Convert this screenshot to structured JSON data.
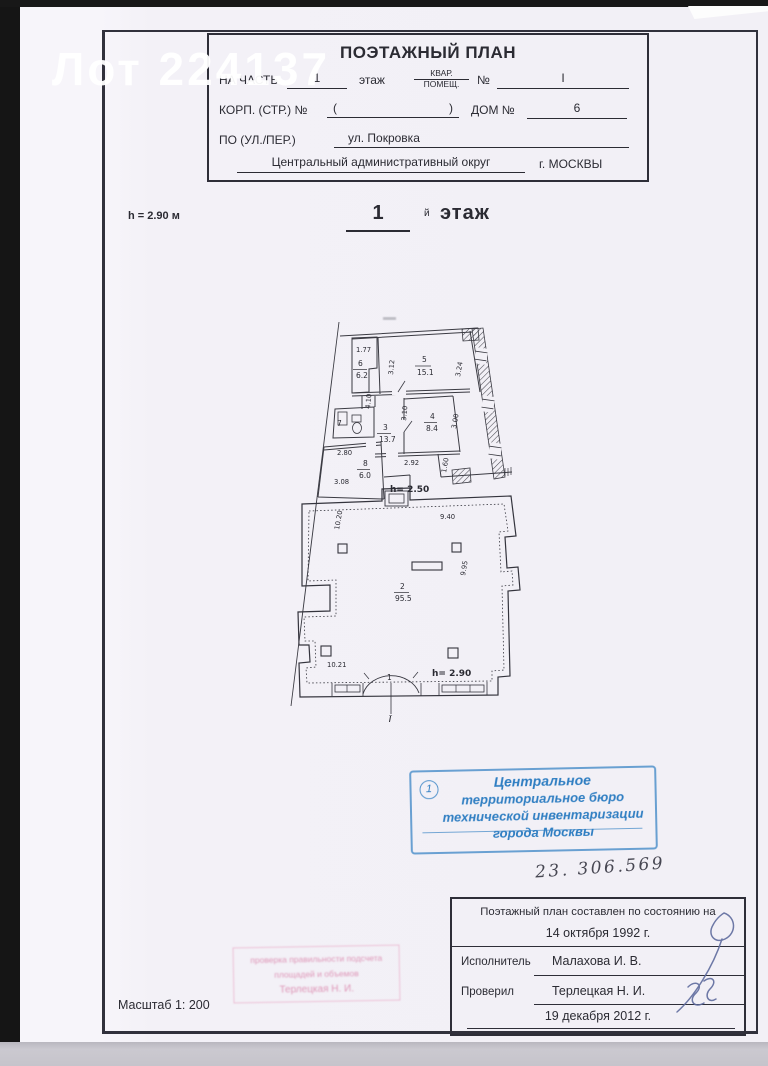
{
  "watermark": "Лот 224137",
  "header": {
    "title": "ПОЭТАЖНЫЙ ПЛАН",
    "na_chast_label": "НА ЧАСТЬ",
    "floor_value": "1",
    "floor_word": "этаж",
    "kvar": "КВАР.",
    "pomesch": "ПОМЕЩ.",
    "number_sign": "№",
    "number_value": "I",
    "korp_label": "КОРП. (СТР.) №",
    "paren_open": "(",
    "paren_close": ")",
    "dom_label": "ДОМ №",
    "dom_value": "6",
    "street_label": "ПО (УЛ./ПЕР.)",
    "street_value": "ул. Покровка",
    "district": "Центральный административный округ",
    "city": "г. МОСКВЫ"
  },
  "floor_heading": {
    "height_note": "h = 2.90 м",
    "number": "1",
    "suffix": "й",
    "word": "этаж"
  },
  "plan": {
    "labels": [
      {
        "t": "1.77"
      },
      {
        "t": "6"
      },
      {
        "t": "6.2"
      },
      {
        "t": "3.12"
      },
      {
        "t": "5"
      },
      {
        "t": "15.1"
      },
      {
        "t": "3.24"
      },
      {
        "t": "4.10"
      },
      {
        "t": "7"
      },
      {
        "t": "3"
      },
      {
        "t": "13.7"
      },
      {
        "t": "3.10"
      },
      {
        "t": "4"
      },
      {
        "t": "8.4"
      },
      {
        "t": "3.00"
      },
      {
        "t": "2.80"
      },
      {
        "t": "8"
      },
      {
        "t": "6.0"
      },
      {
        "t": "3.08"
      },
      {
        "t": "2.92"
      },
      {
        "t": "1.60"
      },
      {
        "t": "h= 2.50"
      },
      {
        "t": "10.20"
      },
      {
        "t": "9.40"
      },
      {
        "t": "9.95"
      },
      {
        "t": "2"
      },
      {
        "t": "95.5"
      },
      {
        "t": "10.21"
      },
      {
        "t": "1"
      },
      {
        "t": "h= 2.90"
      },
      {
        "t": "I"
      }
    ]
  },
  "stamp_blue": {
    "number": "1",
    "line1": "Центральное",
    "line2": "территориальное бюро",
    "line3": "технической инвентаризации",
    "line4": "города Москвы"
  },
  "handwritten_number": "23. 306.569",
  "bottom_table": {
    "line1": "Поэтажный план составлен по состоянию на",
    "date1": "14 октября 1992 г.",
    "executor_label": "Исполнитель",
    "executor_name": "Малахова И. В.",
    "checker_label": "Проверил",
    "checker_name": "Терлецкая Н. И.",
    "date2": "19 декабря 2012 г."
  },
  "stamp_pink": {
    "line1": "проверка правильности подсчета",
    "line2": "площадей и объемов",
    "line3": "Терлецкая Н. И."
  },
  "scale_label": "Масштаб 1: 200",
  "colors": {
    "stamp_blue": "#2f7ec2",
    "stamp_pink": "#d678a4",
    "paper": "#f3f1f7"
  }
}
